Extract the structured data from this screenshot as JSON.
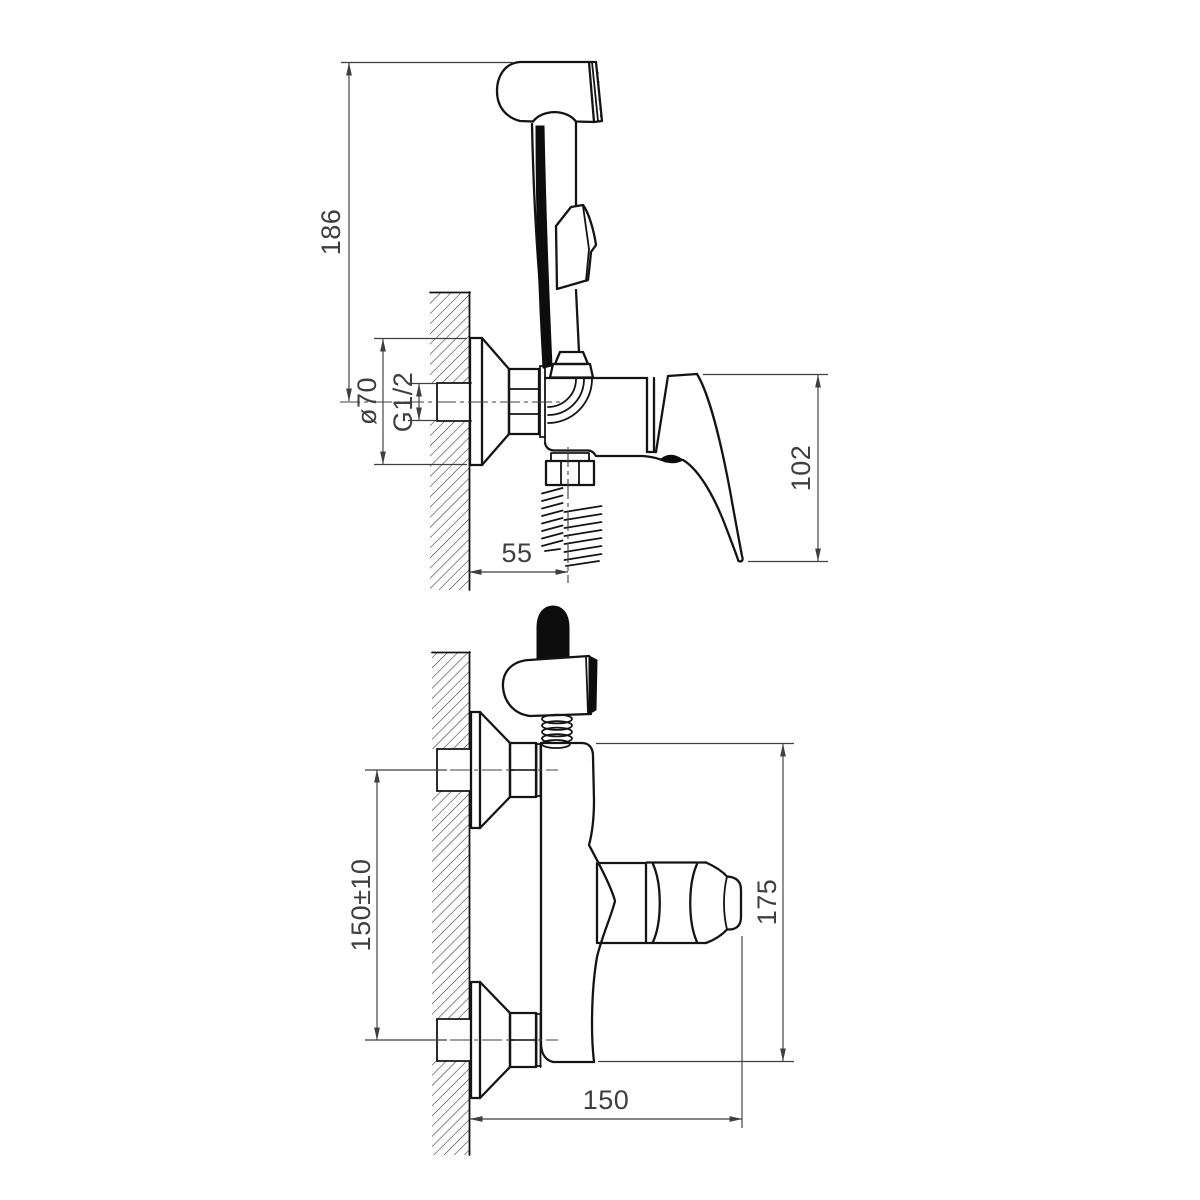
{
  "drawing": {
    "kind": "faucet-installation-dimension-drawing",
    "views": {
      "side": {
        "dims": {
          "overall_height": "186",
          "flange_diameter": "ø70",
          "thread": "G1/2",
          "outlet_offset": "55",
          "handle_height": "102"
        }
      },
      "front": {
        "dims": {
          "inlet_spacing": "150±10",
          "body_height": "175",
          "projection": "150"
        }
      }
    },
    "colors": {
      "object_line": "#141414",
      "dimension_line": "#3f3f3f",
      "background": "#ffffff"
    }
  }
}
